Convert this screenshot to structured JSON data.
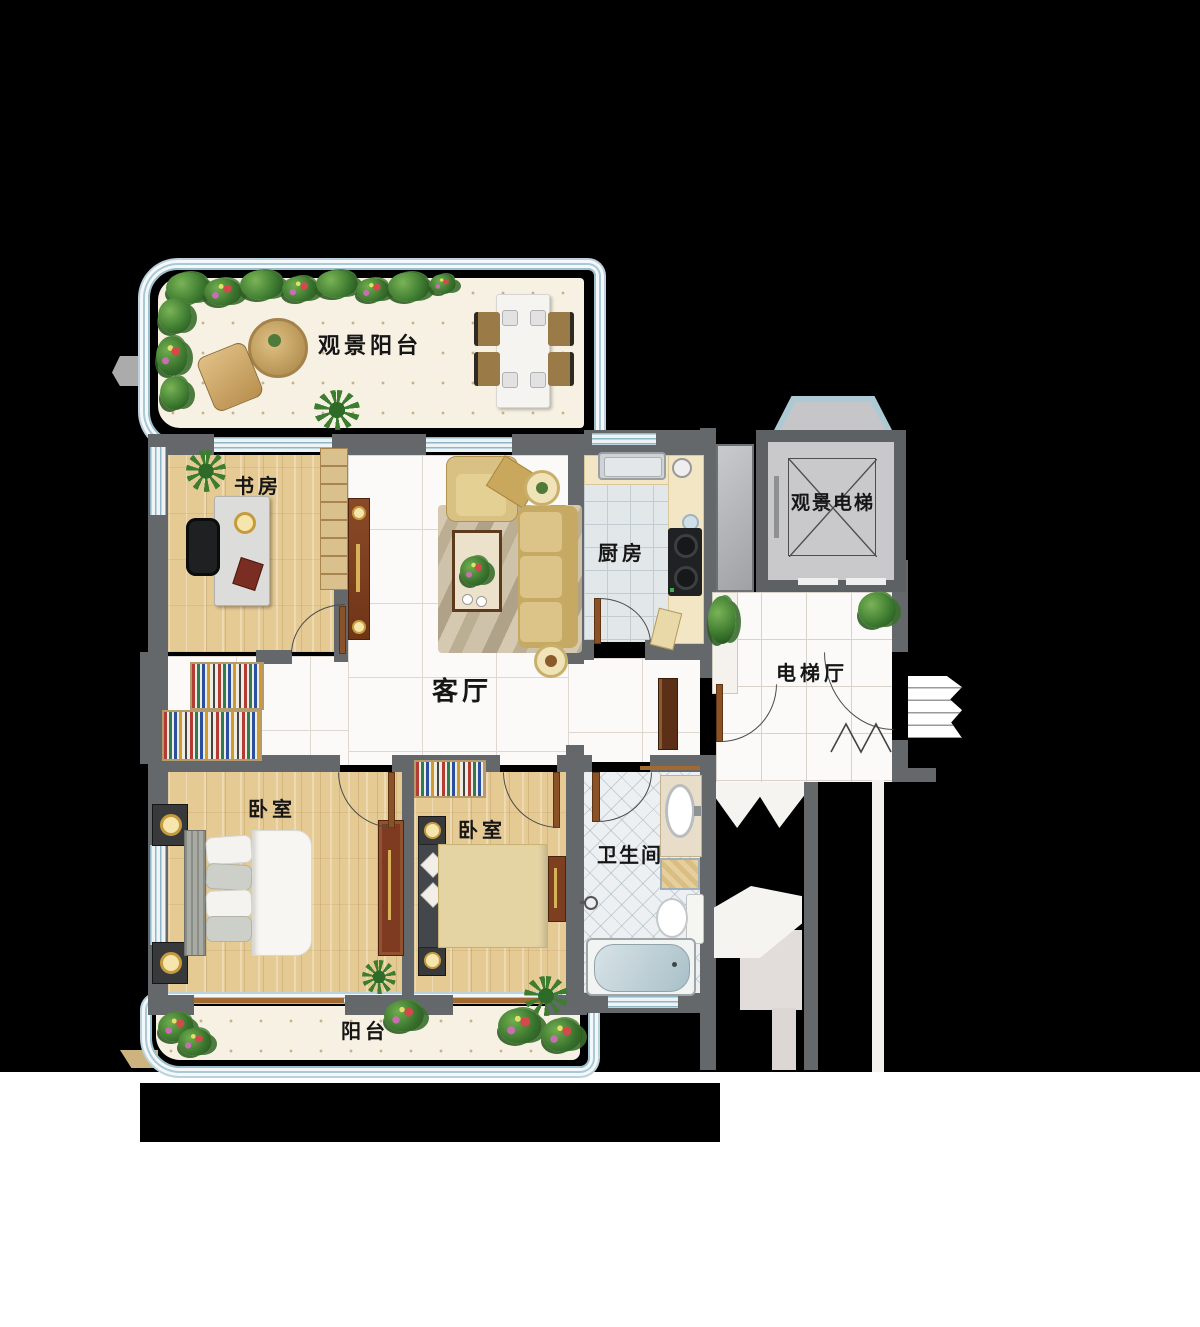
{
  "rooms": {
    "viewing_balcony": {
      "label": "观景阳台"
    },
    "study": {
      "label": "书房"
    },
    "living_room": {
      "label": "客厅"
    },
    "kitchen": {
      "label": "厨房"
    },
    "elevator": {
      "label": "观景电梯"
    },
    "elevator_hall": {
      "label": "电梯厅"
    },
    "master_bedroom": {
      "label": "卧室"
    },
    "second_bedroom": {
      "label": "卧室"
    },
    "bathroom": {
      "label": "卫生间"
    },
    "balcony": {
      "label": "阳台"
    }
  },
  "colors": {
    "background": "#000000",
    "page_bottom": "#ffffff",
    "wall": "#64686b",
    "glass_railing": "#9cc0ce",
    "wood_floor": "#e6ca94",
    "marble_floor": "#fbfaf8",
    "kitchen_floor": "#e2e7ea",
    "bath_floor": "#edf0f2",
    "balcony_floor": "#f7f1e4",
    "label_text": "#161616",
    "sofa": "#d9c183",
    "wardrobe": "#7e3b22",
    "stove": "#1f2123",
    "elevator_cab": "#c9c9cc"
  }
}
